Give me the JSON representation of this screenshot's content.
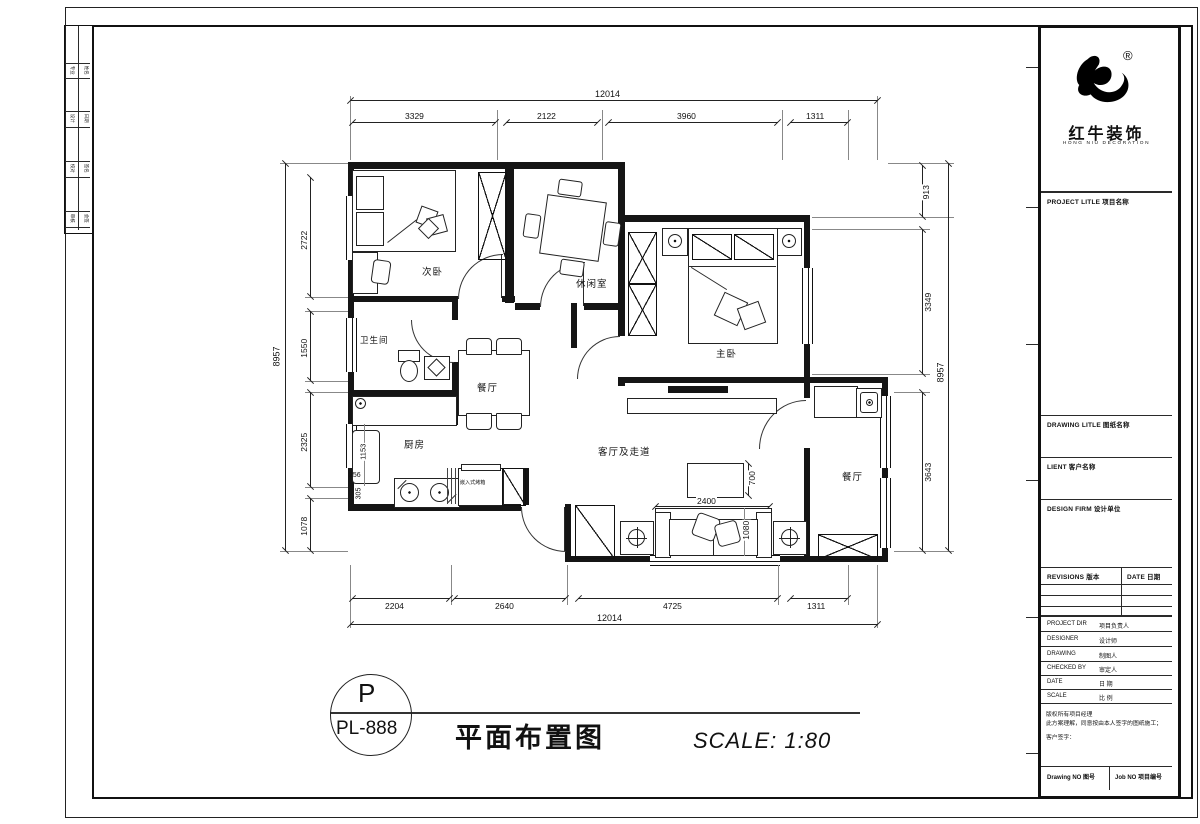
{
  "plan": {
    "rooms": {
      "bedroom2": "次卧",
      "leisure": "休闲室",
      "master": "主卧",
      "bath": "卫生间",
      "dining": "餐厅",
      "kitchen": "厨房",
      "living": "客厅及走道",
      "balcony_dining": "餐厅",
      "appliance": "嵌入式烤箱"
    },
    "dims": {
      "top": {
        "total": "12014",
        "segs": [
          "3329",
          "2122",
          "3960",
          "1311"
        ]
      },
      "bottom": {
        "total": "12014",
        "segs": [
          "2204",
          "2640",
          "4725",
          "1311"
        ]
      },
      "left": {
        "total": "8957",
        "segs": [
          "2722",
          "1550",
          "2325",
          "1078"
        ]
      },
      "right": {
        "total": "8957",
        "segs": [
          "913",
          "3349",
          "3643"
        ]
      },
      "inner": {
        "sofa_w": "2400",
        "table_d": "700",
        "sofa_d": "1080",
        "fridge_h": "1153",
        "k1": "256",
        "k2": "305"
      }
    }
  },
  "titlebar": {
    "tag_top": "P",
    "tag_bottom": "PL-888",
    "title": "平面布置图",
    "scale": "SCALE: 1:80"
  },
  "titleblock": {
    "brand": {
      "reg": "®",
      "name": "红牛装饰",
      "name_en": "HONG NIU DECORATION"
    },
    "project_header": "PROJECT LITLE 项目名称",
    "drawing_header": "DRAWING LITLE 图纸名称",
    "client_header": "LIENT 客户名称",
    "firm_header": "DESIGN FIRM 设计单位",
    "revisions": {
      "col1": "REVISIONS 版本",
      "col2": "DATE 日期"
    },
    "fields": [
      {
        "en": "PROJECT DIR",
        "cn": "项目负责人"
      },
      {
        "en": "DESIGNER",
        "cn": "设计师"
      },
      {
        "en": "DRAWING",
        "cn": "制图人"
      },
      {
        "en": "CHECKED BY",
        "cn": "审定人"
      },
      {
        "en": "DATE",
        "cn": "日 期"
      },
      {
        "en": "SCALE",
        "cn": "比 例"
      }
    ],
    "note_lines": [
      "版权所有项目经理",
      "此方案理解，同意按由本人签字的图纸施工；",
      "客户签字："
    ],
    "footer": {
      "left": "Drawing NO 图号",
      "right": "Job NO 项目编号"
    }
  },
  "side_strip": {
    "cells": [
      [
        "专业",
        "姓名"
      ],
      [
        "设计",
        "日期"
      ],
      [
        "校对",
        "签名"
      ],
      [
        "审核",
        "会签"
      ]
    ]
  }
}
